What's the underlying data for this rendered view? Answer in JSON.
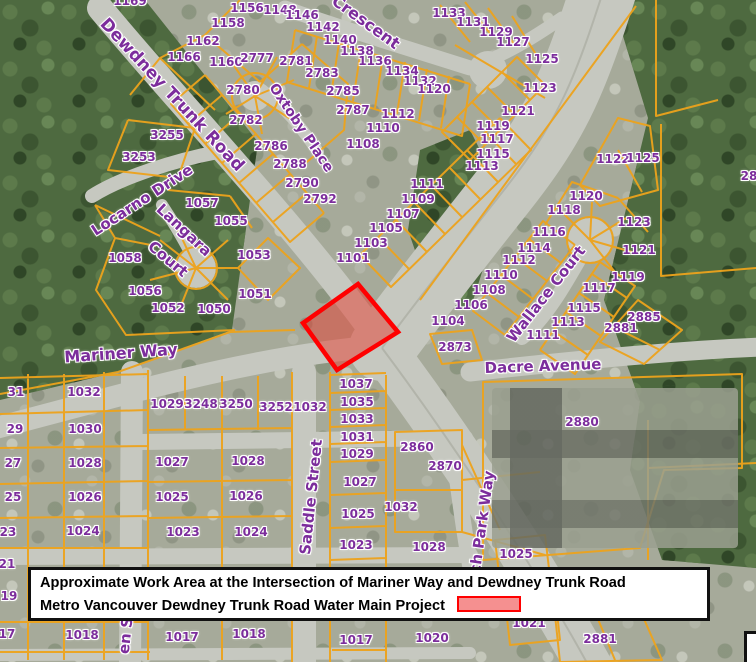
{
  "map": {
    "colors": {
      "parcel_line": "#eda31c",
      "label_purple": "#7c2d9c",
      "road": "#c6c8c0",
      "forest": "#4e6a40",
      "suburb": "#a6aa9a"
    },
    "work_area": {
      "points": "358,284 398,332 337,370 303,323",
      "fill": "rgba(229,60,45,0.5)",
      "border": "#ff0000"
    },
    "street_labels": [
      {
        "t": "Dewdney Trunk Road",
        "x": 172,
        "y": 95,
        "r": 47,
        "s": 17
      },
      {
        "t": "Crescent",
        "x": 366,
        "y": 22,
        "r": 36,
        "s": 16
      },
      {
        "t": "Oxtoby Place",
        "x": 301,
        "y": 128,
        "r": 56,
        "s": 14
      },
      {
        "t": "Locarno Drive",
        "x": 142,
        "y": 200,
        "r": -33,
        "s": 15
      },
      {
        "t": "Langara",
        "x": 184,
        "y": 230,
        "r": 43,
        "s": 15
      },
      {
        "t": "Court",
        "x": 168,
        "y": 259,
        "r": 40,
        "s": 15
      },
      {
        "t": "Mariner Way",
        "x": 121,
        "y": 353,
        "r": -4,
        "s": 16
      },
      {
        "t": "Wallace Court",
        "x": 546,
        "y": 294,
        "r": -52,
        "s": 15
      },
      {
        "t": "Dacre Avenue",
        "x": 543,
        "y": 366,
        "r": -2,
        "s": 15
      },
      {
        "t": "Saddle Street",
        "x": 311,
        "y": 497,
        "r": -84,
        "s": 15
      },
      {
        "t": "ch Park Way",
        "x": 482,
        "y": 522,
        "r": -82,
        "s": 15
      },
      {
        "t": "en St",
        "x": 126,
        "y": 632,
        "r": -84,
        "s": 15
      }
    ],
    "parcel_labels": [
      {
        "t": "1169",
        "x": 130,
        "y": 1
      },
      {
        "t": "1156",
        "x": 247,
        "y": 8
      },
      {
        "t": "1158",
        "x": 228,
        "y": 23
      },
      {
        "t": "1162",
        "x": 203,
        "y": 41
      },
      {
        "t": "1166",
        "x": 184,
        "y": 57
      },
      {
        "t": "1160",
        "x": 226,
        "y": 62
      },
      {
        "t": "2777",
        "x": 257,
        "y": 58
      },
      {
        "t": "2781",
        "x": 296,
        "y": 61
      },
      {
        "t": "2783",
        "x": 322,
        "y": 73
      },
      {
        "t": "2785",
        "x": 343,
        "y": 91
      },
      {
        "t": "2787",
        "x": 353,
        "y": 110
      },
      {
        "t": "2780",
        "x": 243,
        "y": 90
      },
      {
        "t": "2782",
        "x": 246,
        "y": 120
      },
      {
        "t": "2786",
        "x": 271,
        "y": 146
      },
      {
        "t": "2788",
        "x": 290,
        "y": 164
      },
      {
        "t": "2790",
        "x": 302,
        "y": 183
      },
      {
        "t": "2792",
        "x": 320,
        "y": 199
      },
      {
        "t": "3255",
        "x": 167,
        "y": 135
      },
      {
        "t": "3253",
        "x": 139,
        "y": 157
      },
      {
        "t": "1148",
        "x": 280,
        "y": 10
      },
      {
        "t": "1146",
        "x": 302,
        "y": 15
      },
      {
        "t": "1142",
        "x": 323,
        "y": 27
      },
      {
        "t": "1140",
        "x": 340,
        "y": 40
      },
      {
        "t": "1138",
        "x": 357,
        "y": 51
      },
      {
        "t": "1136",
        "x": 375,
        "y": 61
      },
      {
        "t": "1134",
        "x": 402,
        "y": 71
      },
      {
        "t": "1132",
        "x": 420,
        "y": 81
      },
      {
        "t": "1120",
        "x": 434,
        "y": 89
      },
      {
        "t": "1133",
        "x": 449,
        "y": 13
      },
      {
        "t": "1131",
        "x": 473,
        "y": 22
      },
      {
        "t": "1129",
        "x": 496,
        "y": 32
      },
      {
        "t": "1127",
        "x": 513,
        "y": 42
      },
      {
        "t": "1125",
        "x": 542,
        "y": 59
      },
      {
        "t": "1123",
        "x": 540,
        "y": 88
      },
      {
        "t": "1121",
        "x": 518,
        "y": 111
      },
      {
        "t": "1112",
        "x": 398,
        "y": 114
      },
      {
        "t": "1110",
        "x": 383,
        "y": 128
      },
      {
        "t": "1108",
        "x": 363,
        "y": 144
      },
      {
        "t": "1119",
        "x": 493,
        "y": 126
      },
      {
        "t": "1117",
        "x": 497,
        "y": 139
      },
      {
        "t": "1115",
        "x": 493,
        "y": 154
      },
      {
        "t": "1113",
        "x": 482,
        "y": 166
      },
      {
        "t": "1111",
        "x": 427,
        "y": 184
      },
      {
        "t": "1109",
        "x": 418,
        "y": 199
      },
      {
        "t": "1107",
        "x": 403,
        "y": 214
      },
      {
        "t": "1105",
        "x": 386,
        "y": 228
      },
      {
        "t": "1103",
        "x": 371,
        "y": 243
      },
      {
        "t": "1101",
        "x": 353,
        "y": 258
      },
      {
        "t": "1122",
        "x": 613,
        "y": 159
      },
      {
        "t": "1125",
        "x": 643,
        "y": 158
      },
      {
        "t": "28",
        "x": 749,
        "y": 176
      },
      {
        "t": "1057",
        "x": 202,
        "y": 203
      },
      {
        "t": "1055",
        "x": 231,
        "y": 221
      },
      {
        "t": "1053",
        "x": 254,
        "y": 255
      },
      {
        "t": "1058",
        "x": 125,
        "y": 258
      },
      {
        "t": "1056",
        "x": 145,
        "y": 291
      },
      {
        "t": "1052",
        "x": 168,
        "y": 308
      },
      {
        "t": "1050",
        "x": 214,
        "y": 309
      },
      {
        "t": "1051",
        "x": 255,
        "y": 294
      },
      {
        "t": "1116",
        "x": 549,
        "y": 232
      },
      {
        "t": "1114",
        "x": 534,
        "y": 248
      },
      {
        "t": "1112",
        "x": 519,
        "y": 260
      },
      {
        "t": "1110",
        "x": 501,
        "y": 275
      },
      {
        "t": "1108",
        "x": 489,
        "y": 290
      },
      {
        "t": "1106",
        "x": 471,
        "y": 305
      },
      {
        "t": "1104",
        "x": 448,
        "y": 321
      },
      {
        "t": "1120",
        "x": 586,
        "y": 196
      },
      {
        "t": "1118",
        "x": 564,
        "y": 210
      },
      {
        "t": "1123",
        "x": 634,
        "y": 222
      },
      {
        "t": "1121",
        "x": 639,
        "y": 250
      },
      {
        "t": "1119",
        "x": 628,
        "y": 277
      },
      {
        "t": "1117",
        "x": 599,
        "y": 288
      },
      {
        "t": "1115",
        "x": 584,
        "y": 308
      },
      {
        "t": "1113",
        "x": 568,
        "y": 322
      },
      {
        "t": "1111",
        "x": 543,
        "y": 335
      },
      {
        "t": "2885",
        "x": 644,
        "y": 317
      },
      {
        "t": "2881",
        "x": 621,
        "y": 328
      },
      {
        "t": "2873",
        "x": 455,
        "y": 347
      },
      {
        "t": "2880",
        "x": 582,
        "y": 422
      },
      {
        "t": "31",
        "x": 16,
        "y": 392
      },
      {
        "t": "1032",
        "x": 84,
        "y": 392
      },
      {
        "t": "29",
        "x": 15,
        "y": 429
      },
      {
        "t": "1030",
        "x": 85,
        "y": 429
      },
      {
        "t": "27",
        "x": 13,
        "y": 463
      },
      {
        "t": "1028",
        "x": 85,
        "y": 463
      },
      {
        "t": "25",
        "x": 13,
        "y": 497
      },
      {
        "t": "1026",
        "x": 85,
        "y": 497
      },
      {
        "t": "23",
        "x": 8,
        "y": 532
      },
      {
        "t": "1024",
        "x": 83,
        "y": 531
      },
      {
        "t": "21",
        "x": 7,
        "y": 564
      },
      {
        "t": "19",
        "x": 9,
        "y": 596
      },
      {
        "t": "17",
        "x": 7,
        "y": 634
      },
      {
        "t": "1018",
        "x": 82,
        "y": 635
      },
      {
        "t": "1029",
        "x": 167,
        "y": 404
      },
      {
        "t": "3248",
        "x": 201,
        "y": 404
      },
      {
        "t": "3250",
        "x": 236,
        "y": 404
      },
      {
        "t": "3252",
        "x": 276,
        "y": 407
      },
      {
        "t": "1032",
        "x": 310,
        "y": 407
      },
      {
        "t": "1027",
        "x": 172,
        "y": 462
      },
      {
        "t": "1028",
        "x": 248,
        "y": 461
      },
      {
        "t": "1025",
        "x": 172,
        "y": 497
      },
      {
        "t": "1026",
        "x": 246,
        "y": 496
      },
      {
        "t": "1023",
        "x": 183,
        "y": 532
      },
      {
        "t": "1024",
        "x": 251,
        "y": 532
      },
      {
        "t": "1017",
        "x": 182,
        "y": 637
      },
      {
        "t": "1018",
        "x": 249,
        "y": 634
      },
      {
        "t": "1037",
        "x": 356,
        "y": 384
      },
      {
        "t": "1035",
        "x": 357,
        "y": 402
      },
      {
        "t": "1033",
        "x": 357,
        "y": 419
      },
      {
        "t": "1031",
        "x": 357,
        "y": 437
      },
      {
        "t": "1029",
        "x": 357,
        "y": 454
      },
      {
        "t": "1027",
        "x": 360,
        "y": 482
      },
      {
        "t": "1025",
        "x": 358,
        "y": 514
      },
      {
        "t": "1023",
        "x": 356,
        "y": 545
      },
      {
        "t": "2860",
        "x": 417,
        "y": 447
      },
      {
        "t": "2870",
        "x": 445,
        "y": 466
      },
      {
        "t": "1032",
        "x": 401,
        "y": 507
      },
      {
        "t": "1028",
        "x": 429,
        "y": 547
      },
      {
        "t": "1025",
        "x": 516,
        "y": 554
      },
      {
        "t": "1021",
        "x": 529,
        "y": 623
      },
      {
        "t": "1017",
        "x": 356,
        "y": 640
      },
      {
        "t": "1020",
        "x": 432,
        "y": 638
      },
      {
        "t": "2881",
        "x": 600,
        "y": 639
      }
    ]
  },
  "caption": {
    "line1": "Approximate Work Area at the Intersection of Mariner Way and Dewdney Trunk Road",
    "line2": "Metro Vancouver Dewdney Trunk Road Water Main Project",
    "swatch": {
      "fill": "#f59090",
      "border": "#ff0000"
    }
  }
}
